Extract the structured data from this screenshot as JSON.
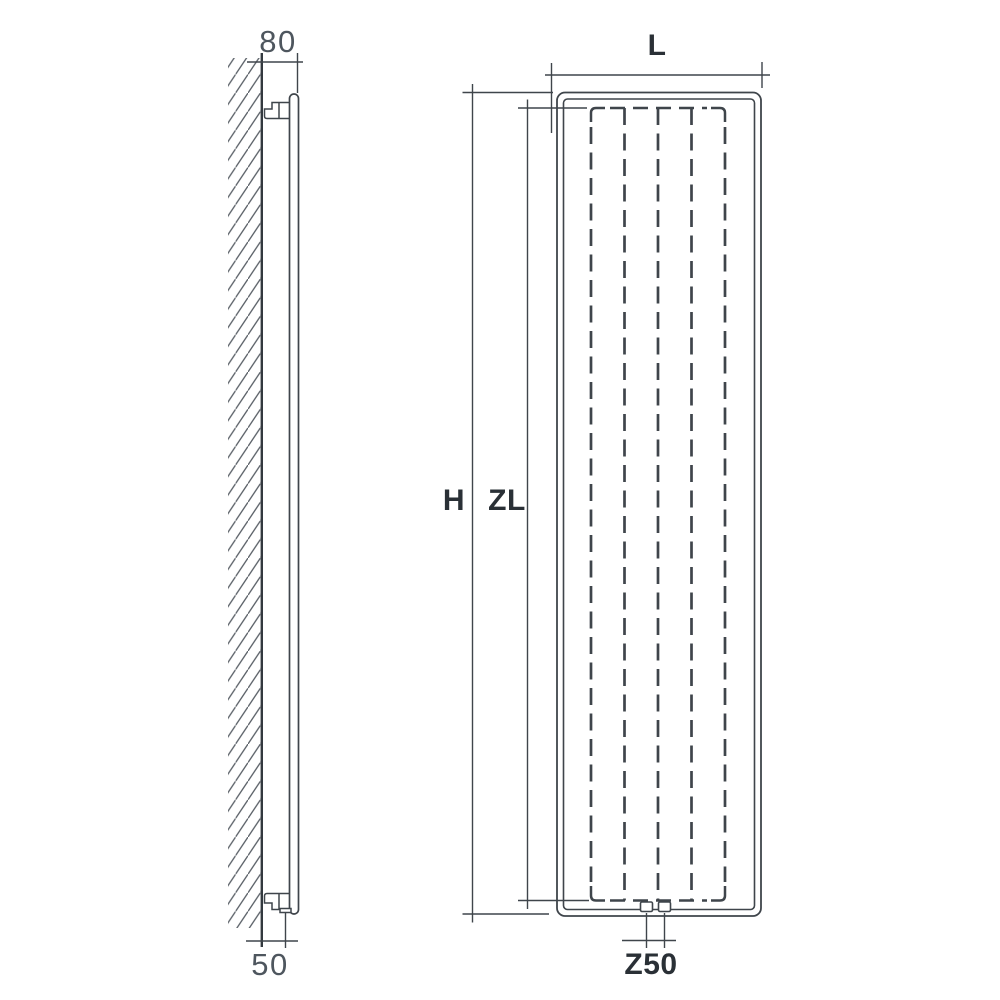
{
  "drawing": {
    "description": "Vertical radiator technical drawing: wall-mounted side view and front view with dimension lines"
  },
  "colors": {
    "background": "#ffffff",
    "line": "#3f454b",
    "line_strong": "#33393f",
    "hatch": "#5a6067",
    "dim_number": "#4e565e",
    "dim_label": "#2a3036"
  },
  "side_view": {
    "dim_wall_offset_top": "80",
    "dim_wall_offset_bottom": "50"
  },
  "front_view": {
    "dim_width": "L",
    "dim_height": "H",
    "dim_inner_height": "ZL",
    "dim_connection_spacing": "Z50"
  }
}
